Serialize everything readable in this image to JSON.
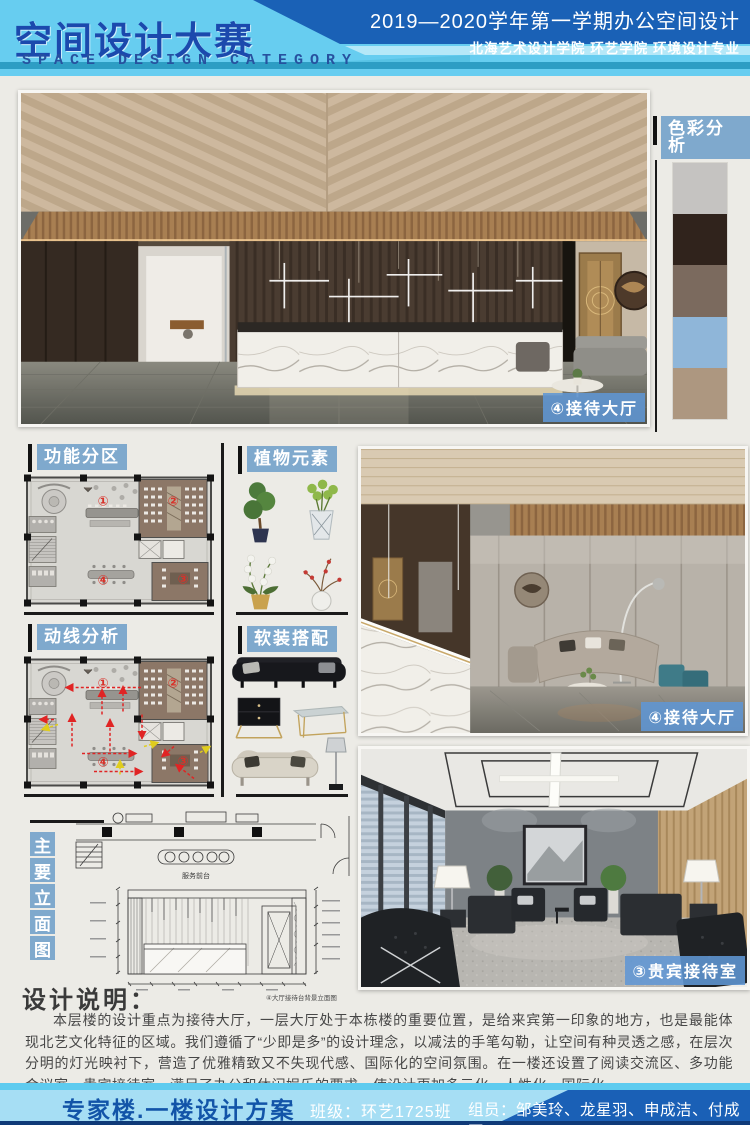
{
  "header": {
    "title": "空间设计大赛",
    "subtitle": "SPACE DESIGN CATEGORY",
    "session": "2019—2020学年第一学期办公空间设计",
    "school": "北海艺术设计学院 环艺学院 环境设计专业"
  },
  "color_analysis": {
    "label": "色彩分析",
    "swatches": [
      "#c5c3c1",
      "#30231c",
      "#7b6a5e",
      "#8fb6d9",
      "#ad9780"
    ]
  },
  "panels": {
    "function_zoning_label": "功能分区",
    "circulation_label": "动线分析",
    "plants_label": "植物元素",
    "soft_furnishing_label": "软装搭配",
    "elevation_title_chars": [
      "主",
      "要",
      "立",
      "面",
      "图"
    ]
  },
  "plan": {
    "zone1": "①",
    "zone2": "②",
    "zone3": "③",
    "zone4": "④"
  },
  "renderings": {
    "lobby_main_label": "④接待大厅",
    "lobby_second_label": "④接待大厅",
    "vip_label": "③贵宾接待室"
  },
  "drawings": {
    "counter_caption": "服务前台",
    "elevation_caption": "④大厅接待台背景立面图"
  },
  "description": {
    "heading": "设计说明：",
    "body": "本层楼的设计重点为接待大厅，一层大厅处于本栋楼的重要位置，是给来宾第一印象的地方，也是最能体现北艺文化特征的区域。我们遵循了“少即是多”的设计理念，以减法的手笔勾勒，让空间有种灵透之感，在层次分明的灯光映衬下，营造了优雅精致又不失现代感、国际化的空间氛围。在一楼还设置了阅读交流区、多功能会议室、贵宾接待室，满足了办公和休闲娱乐的要求，使设计更加多元化、人性化、国际化。"
  },
  "footer": {
    "project": "专家楼.一楼设计方案",
    "class_info": "班级：环艺1725班",
    "members": "组员：邹美玲、龙星羽、申成洁、付成军"
  },
  "colors": {
    "header_light_blue": "#67cdf0",
    "header_dark_blue": "#1a61b6",
    "title_blue": "#1b49ad",
    "teal_stripe": "#2d9dc4",
    "label_blue": "#7fa9cd",
    "poster_background": "#ecebe6",
    "accent_red": "#d8322a",
    "footer_blue": "#1a60b6"
  }
}
